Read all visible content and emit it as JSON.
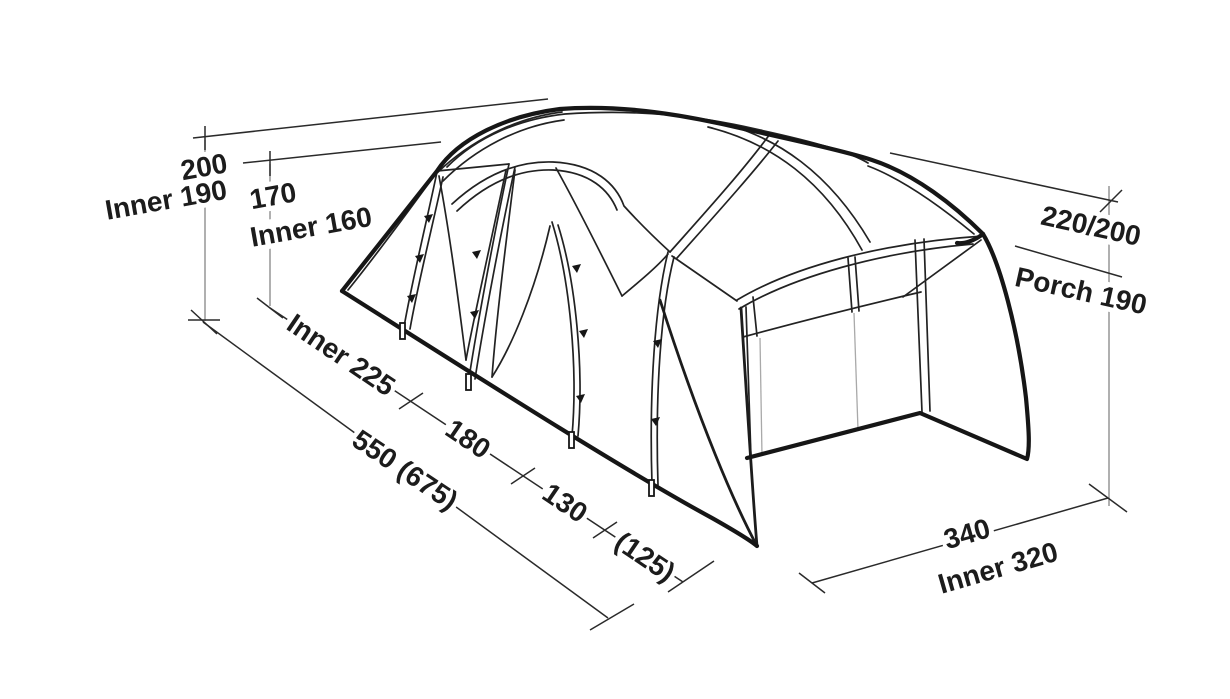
{
  "figure": {
    "description": "Isometric technical line drawing of a tunnel tent with porch, annotated with dimension lines",
    "colors": {
      "ink": "#1c1c1c",
      "dim_line": "#2a2a2a",
      "extension_line": "#8f8f8f",
      "background": "#ffffff"
    },
    "labels": {
      "height_main": "200",
      "height_main_inner": "Inner 190",
      "height_mid": "170",
      "height_mid_inner": "Inner 160",
      "height_right": "220/200",
      "height_porch": "Porch 190",
      "length_inner": "Inner 225",
      "length_seg_180": "180",
      "length_seg_130": "130",
      "length_seg_125": "(125)",
      "length_total": "550 (675)",
      "width_outer": "340",
      "width_inner": "Inner 320"
    }
  }
}
